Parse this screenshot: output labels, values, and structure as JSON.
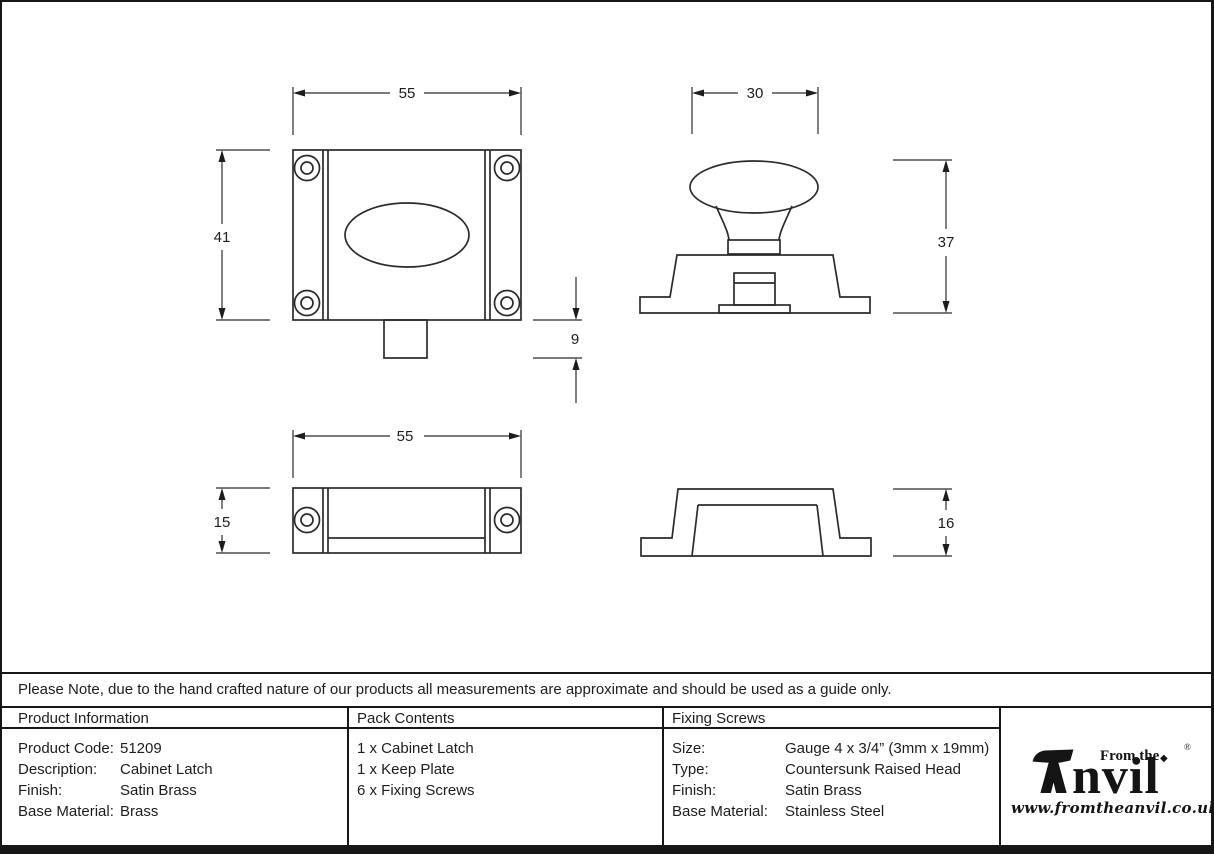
{
  "doc": {
    "note": "Please Note, due to the hand crafted nature of our products all measurements are approximate and should be used as a guide only."
  },
  "drawings": {
    "latch_front": {
      "width": "55",
      "height": "41",
      "bolt": "9"
    },
    "latch_side": {
      "knob_width": "30",
      "height": "37"
    },
    "keep_front": {
      "width": "55",
      "height": "15"
    },
    "keep_side": {
      "height": "16"
    }
  },
  "table": {
    "product_information": {
      "header": "Product Information",
      "rows": [
        {
          "label": "Product Code:",
          "value": "51209"
        },
        {
          "label": "Description:",
          "value": "Cabinet Latch"
        },
        {
          "label": "Finish:",
          "value": "Satin Brass"
        },
        {
          "label": "Base Material:",
          "value": "Brass"
        }
      ]
    },
    "pack_contents": {
      "header": "Pack Contents",
      "items": [
        "1 x Cabinet Latch",
        "1 x Keep Plate",
        "6 x Fixing Screws"
      ]
    },
    "fixing_screws": {
      "header": "Fixing Screws",
      "rows": [
        {
          "label": "Size:",
          "value": "Gauge 4 x 3/4” (3mm x 19mm)"
        },
        {
          "label": "Type:",
          "value": "Countersunk Raised Head"
        },
        {
          "label": "Finish:",
          "value": "Satin Brass"
        },
        {
          "label": "Base Material:",
          "value": "Stainless Steel"
        }
      ]
    }
  },
  "logo": {
    "prefix": "From the",
    "wordmark_rest": "nvil",
    "diamond": "◆",
    "registered": "®",
    "url": "www.fromtheanvil.co.uk"
  },
  "colors": {
    "ink": "#1d1d1d",
    "line": "#2b2b2b"
  }
}
